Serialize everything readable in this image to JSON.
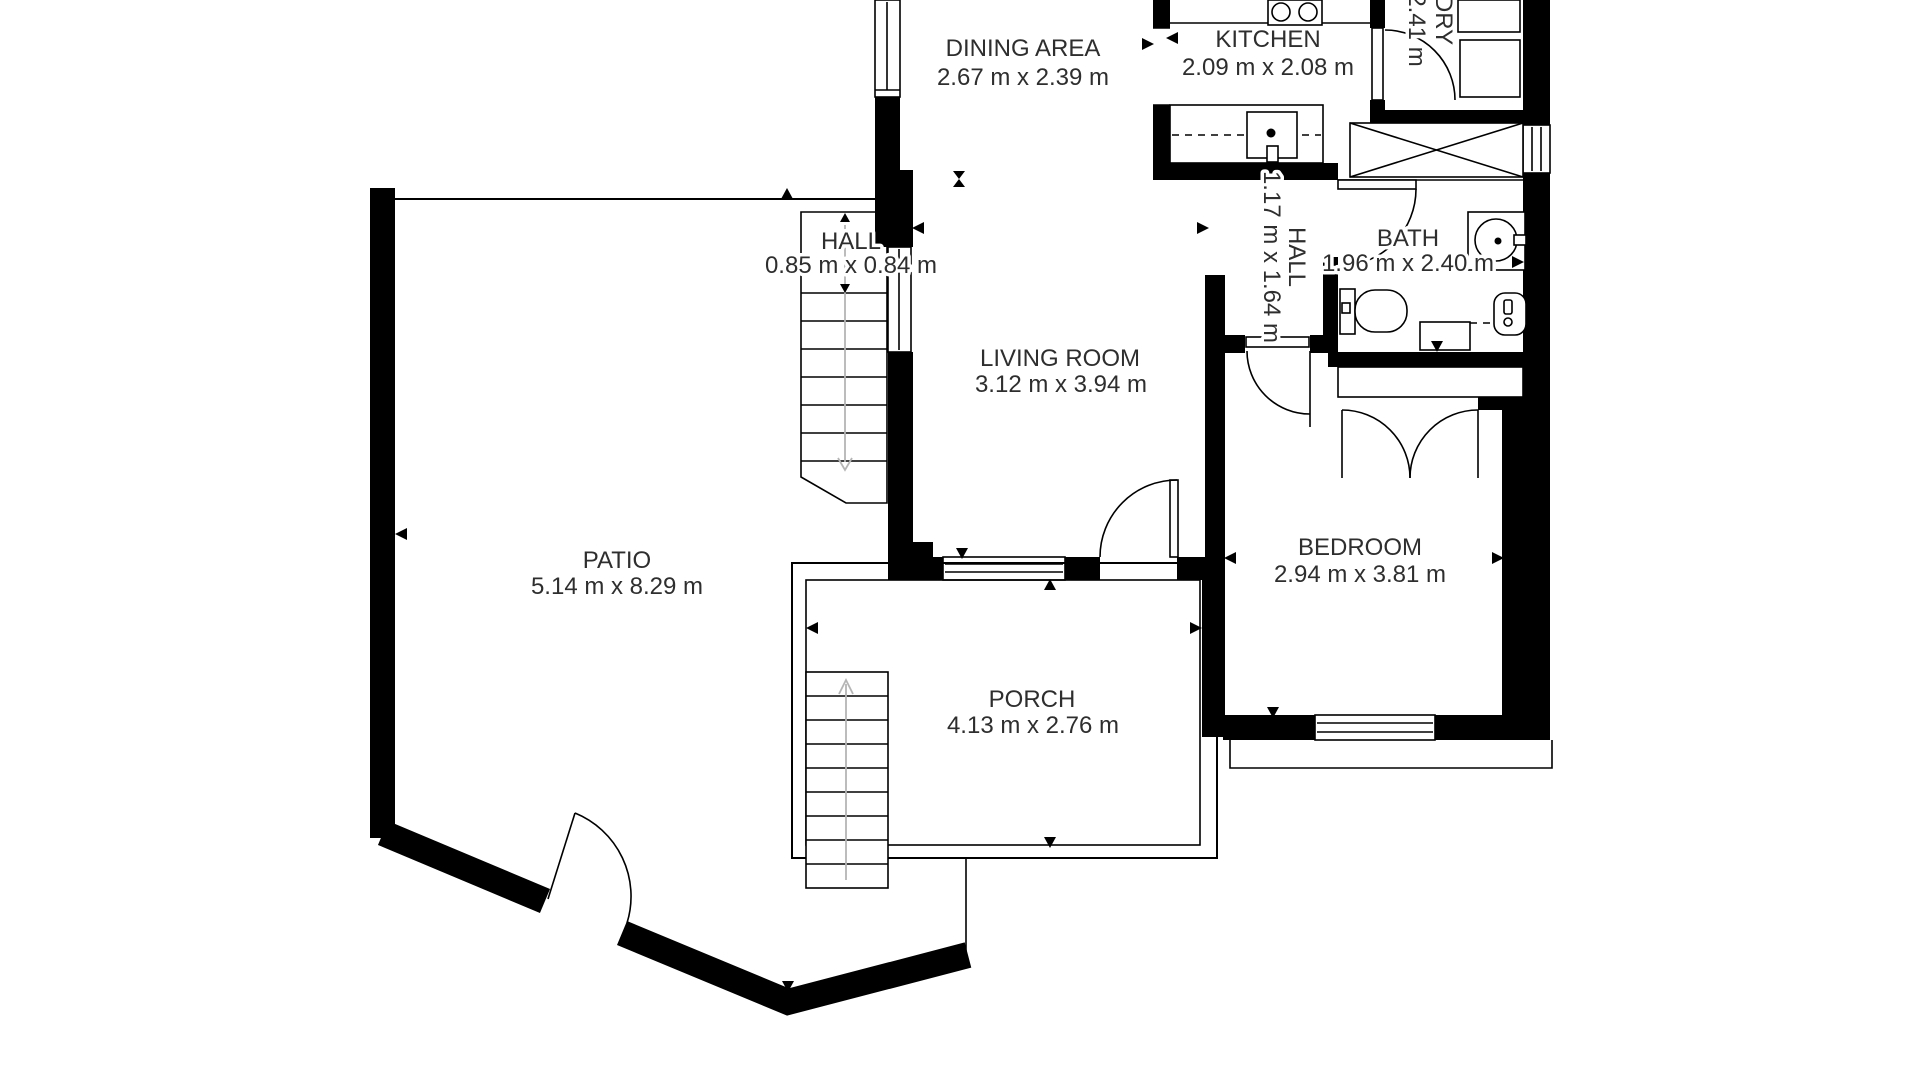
{
  "rooms": {
    "dining": {
      "name": "DINING AREA",
      "dims": "2.67 m x 2.39 m"
    },
    "kitchen": {
      "name": "KITCHEN",
      "dims": "2.09 m x 2.08 m"
    },
    "laundry": {
      "name": "LAUNDRY",
      "dims": "2.41 m"
    },
    "hall_upper": {
      "name": "HALL",
      "dims": "0.85 m x 0.84 m"
    },
    "hall_lower": {
      "name": "HALL",
      "dims": "1.17 m x 1.64 m"
    },
    "bath": {
      "name": "BATH",
      "dims": "1.96 m x 2.40 m"
    },
    "living": {
      "name": "LIVING ROOM",
      "dims": "3.12 m x 3.94 m"
    },
    "patio": {
      "name": "PATIO",
      "dims": "5.14 m x 8.29 m"
    },
    "bedroom": {
      "name": "BEDROOM",
      "dims": "2.94 m x 3.81 m"
    },
    "porch": {
      "name": "PORCH",
      "dims": "4.13 m x 2.76 m"
    }
  },
  "colors": {
    "wall": "#000000",
    "text": "#2e2e2e",
    "faint": "#b5b5b5",
    "page": "#ffffff"
  }
}
